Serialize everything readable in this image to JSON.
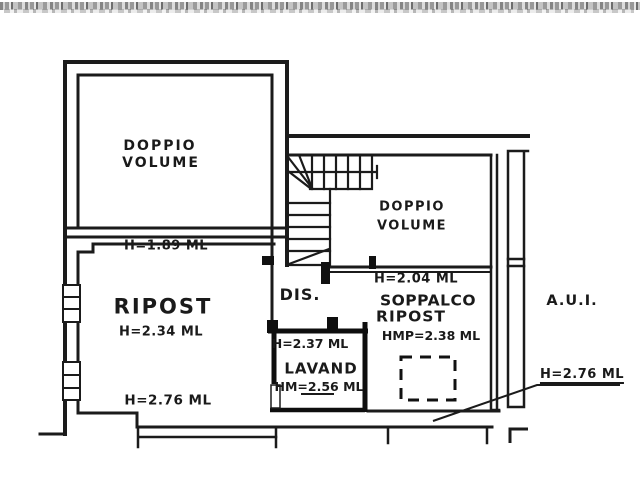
{
  "colors": {
    "ink": "#1a1a1a",
    "paper": "#ffffff"
  },
  "floorplan": {
    "rooms": {
      "doppio_volume_upper": {
        "label_line1": "DOPPIO",
        "label_line2": "VOLUME"
      },
      "doppio_volume_mezzanine": {
        "label_line1": "DOPPIO",
        "label_line2": "VOLUME"
      },
      "ripost": {
        "label": "RIPOST",
        "height_top": "H=1.89 ML",
        "height_middle": "H=2.34 ML",
        "height_bottom": "H=2.76 ML"
      },
      "dis": {
        "label": "DIS."
      },
      "lavand": {
        "label": "LAVAND",
        "height_top": "H=2.37 ML",
        "height_mean": "HM=2.56 ML"
      },
      "soppalco_ripost": {
        "label_line1": "SOPPALCO",
        "label_line2": "RIPOST",
        "height_top": "H=2.04 ML",
        "height_mean": "HMP=2.38 ML"
      },
      "aui": {
        "label": "A.U.I.",
        "height": "H=2.76 ML"
      }
    }
  }
}
